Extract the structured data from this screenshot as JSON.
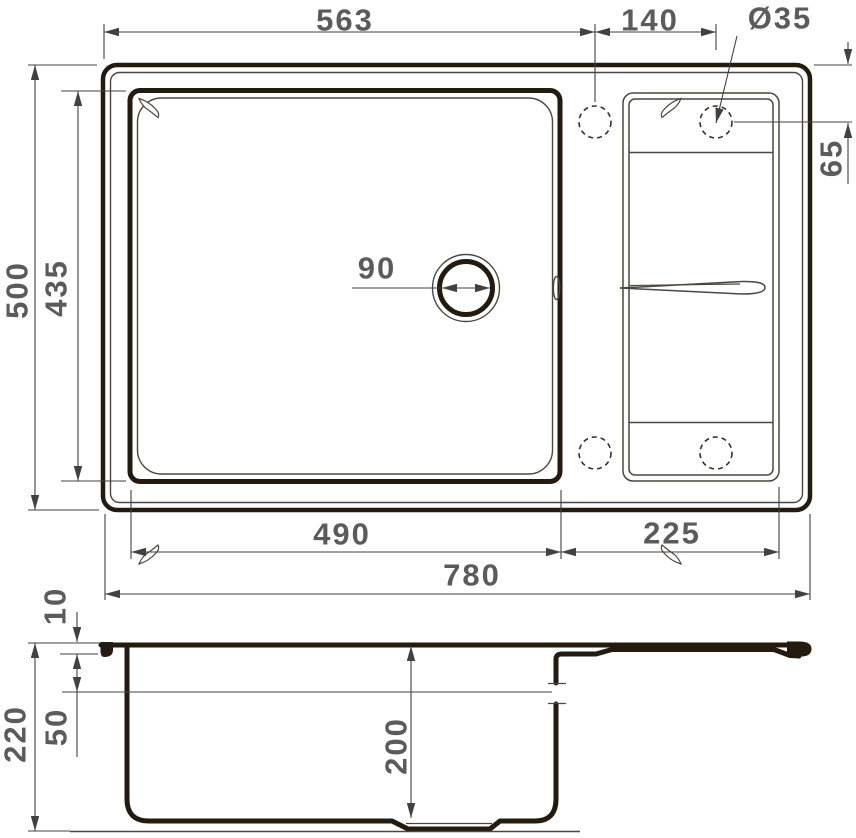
{
  "colors": {
    "line": "#241a10",
    "thin_line": "#4c463f",
    "dimension_line": "#414141",
    "dimension_text": "#5b5b5b",
    "background": "#ffffff"
  },
  "top_view": {
    "dimensions": {
      "left_section_width": "563",
      "tap_hole_spacing": "140",
      "tap_hole_diameter": "Ø35",
      "overall_depth": "500",
      "bowl_depth": "435",
      "tap_hole_offset": "65",
      "drain_diameter": "90",
      "bowl_width": "490",
      "drainboard_width": "225",
      "overall_width": "780"
    }
  },
  "side_view": {
    "dimensions": {
      "rim_height": "10",
      "overall_height": "220",
      "ledge_height": "50",
      "bowl_inner_depth": "200"
    }
  }
}
